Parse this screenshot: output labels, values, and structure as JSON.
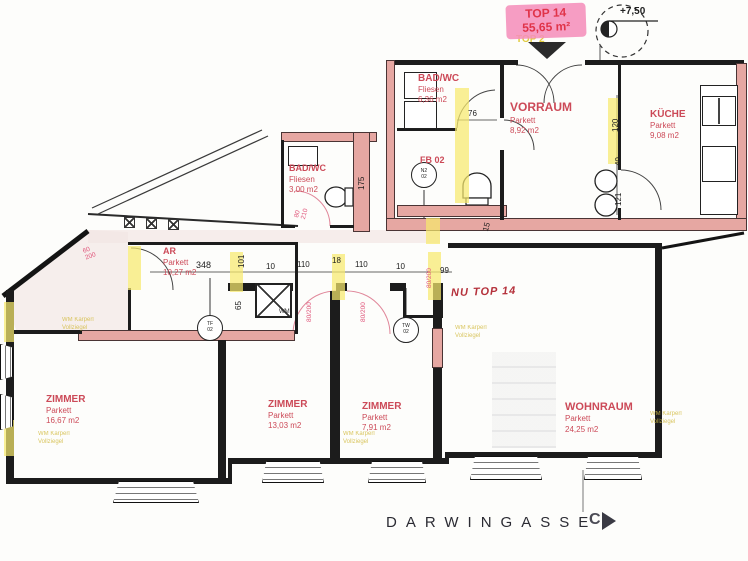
{
  "marker": {
    "unit": "TOP 14",
    "area": "55,65 m²",
    "secondary": "TOP 2",
    "elevation": "+7,50"
  },
  "street": {
    "name": "DARWINGASSE",
    "section": "C"
  },
  "note": "NU TOP 14",
  "rooms": {
    "bad_wc_top": {
      "name": "BAD/WC",
      "finish": "Fliesen",
      "area": "6,36 m2"
    },
    "vorraum": {
      "name": "VORRAUM",
      "finish": "Parkett",
      "area": "8,92 m2"
    },
    "kueche": {
      "name": "KÜCHE",
      "finish": "Parkett",
      "area": "9,08 m2"
    },
    "bad_wc_2": {
      "name": "BAD/WC",
      "finish": "Fliesen",
      "area": "3,00 m2"
    },
    "ar": {
      "name": "AR",
      "finish": "Parkett",
      "area": "10,27 m2"
    },
    "zimmer_1": {
      "name": "ZIMMER",
      "finish": "Parkett",
      "area": "16,67 m2"
    },
    "zimmer_2": {
      "name": "ZIMMER",
      "finish": "Parkett",
      "area": "13,03 m2"
    },
    "zimmer_3": {
      "name": "ZIMMER",
      "finish": "Parkett",
      "area": "7,91 m2"
    },
    "wohnraum": {
      "name": "WOHNRAUM",
      "finish": "Parkett",
      "area": "24,25 m2"
    }
  },
  "labels": {
    "fb": "FB 02",
    "wm": "WM"
  },
  "symbols": {
    "s1": "TF",
    "s2": "TW",
    "s3": "N2",
    "num": "02"
  },
  "dims": {
    "d76": "76",
    "d120": "120",
    "d40": "40",
    "d121": "121",
    "d348": "348",
    "d101": "101",
    "d65": "65",
    "d10": "10",
    "d110": "110",
    "d18": "18",
    "d99": "99",
    "d175": "175",
    "d15": "15",
    "door_ar_w": "60",
    "door_ar_h": "200",
    "door_std": "80/200",
    "door_annex_w": "80",
    "door_annex_h": "210"
  },
  "annotation": {
    "l1": "WM Karperl",
    "l2": "Vollziegel"
  },
  "colors": {
    "red_label": "#cc4a58",
    "pink_wall": "#e6a7a2",
    "highlight": "#f6e96e",
    "marker_pink": "#f58fbb",
    "hand_red": "#b5323c"
  }
}
